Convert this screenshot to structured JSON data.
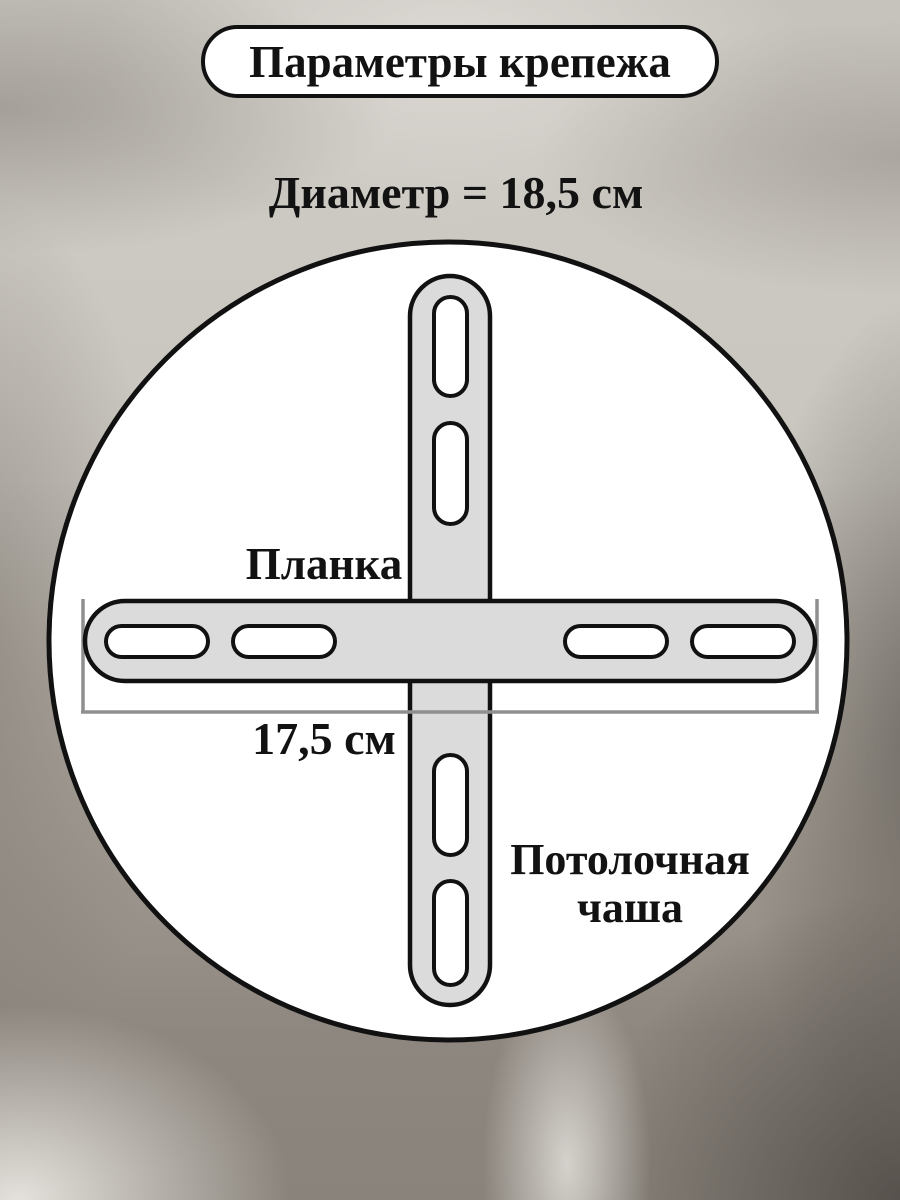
{
  "header": {
    "badge": "Параметры крепежа",
    "diameter_label": "Диаметр = 18,5 см"
  },
  "diagram": {
    "plank_label": "Планка",
    "plank_length_label": "17,5 см",
    "cup_label_line1": "Потолочная",
    "cup_label_line2": "чаша"
  },
  "colors": {
    "outline": "#111111",
    "bracket_fill": "#dbdbdb",
    "slot_fill": "#ffffff",
    "circle_fill": "#ffffff",
    "dimension_line": "#8f8f8f"
  }
}
